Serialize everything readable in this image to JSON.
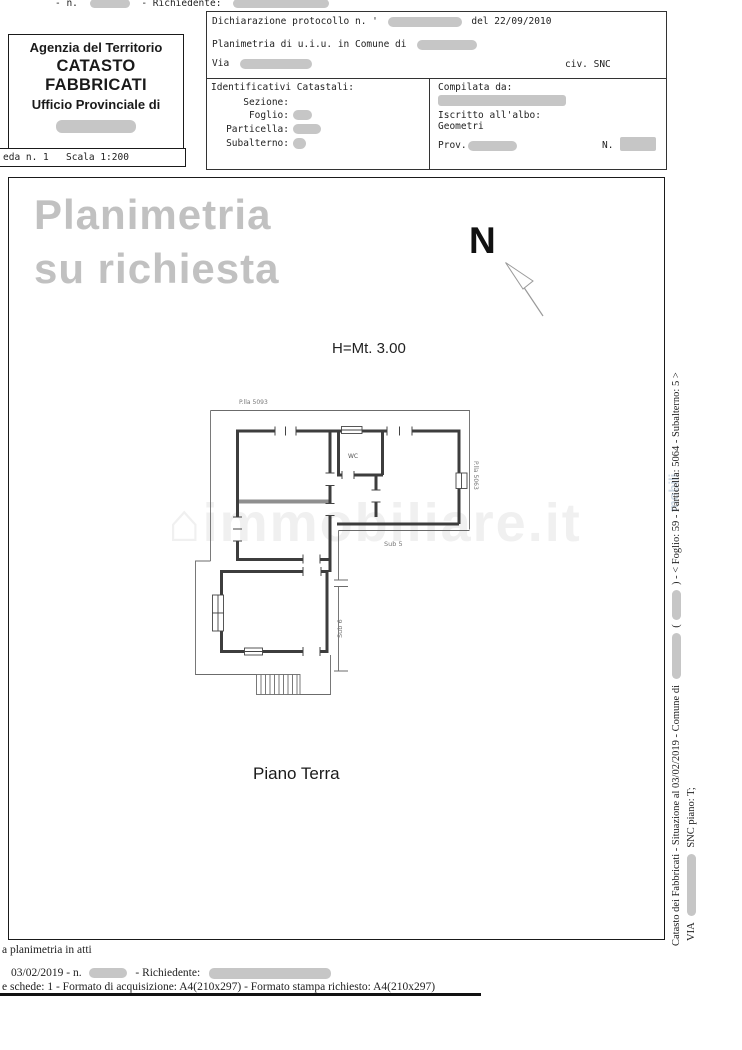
{
  "topline": {
    "n_label": "- n.",
    "requester_label": "- Richiedente:"
  },
  "agency_box": {
    "line1": "Agenzia del Territorio",
    "line2": "CATASTO FABBRICATI",
    "line3": "Ufficio Provinciale di"
  },
  "sheet_strip": {
    "sheet": "eda n. 1",
    "scale": "Scala 1:200"
  },
  "declaration_box": {
    "protocol_label": "Dichiarazione protocollo n. '",
    "protocol_date": "del  22/09/2010",
    "planimetria_line": "Planimetria di u.i.u. in Comune di",
    "via_label": "Via",
    "civ_label": "civ. SNC"
  },
  "identifiers_box": {
    "title": "Identificativi Catastali:",
    "sezione": "Sezione:",
    "foglio": "Foglio:",
    "particella": "Particella:",
    "subalterno": "Subalterno:"
  },
  "compiler_box": {
    "title": "Compilata da:",
    "albo_line1": "Iscritto all'albo:",
    "albo_line2": "Geometri",
    "prov_label": "Prov.",
    "n_label": "N."
  },
  "watermark": {
    "line1": "Planimetria",
    "line2": "su richiesta",
    "house_icon": "⌂",
    "site": "immobiliare.it",
    "side_fragment": "mobili"
  },
  "north_label": "N",
  "height_label": "H=Mt. 3.00",
  "plan": {
    "parcel_top": "P.lla 5093",
    "parcel_right": "P.lla 5063",
    "sub_main": "Sub 5",
    "sub_side": "Sub 6",
    "wc_label": "WC",
    "floor_label": "Piano Terra"
  },
  "sidebar": {
    "line1_part1": "Catasto dei Fabbricati - Situazione al 03/02/2019 - Comune di",
    "line1_part2": "(",
    "line1_part3": ") - <  Foglio: 59 - Particella: 5064 - Subalterno: 5 >",
    "line2_part1": "VIA",
    "line2_part2": "SNC piano: T;"
  },
  "footer": {
    "line1": "a planimetria in atti",
    "line2_part1": "03/02/2019 - n.",
    "line2_part2": "- Richiedente:",
    "line3": "e schede: 1 - Formato di acquisizione: A4(210x297)  - Formato stampa richiesto: A4(210x297)"
  }
}
